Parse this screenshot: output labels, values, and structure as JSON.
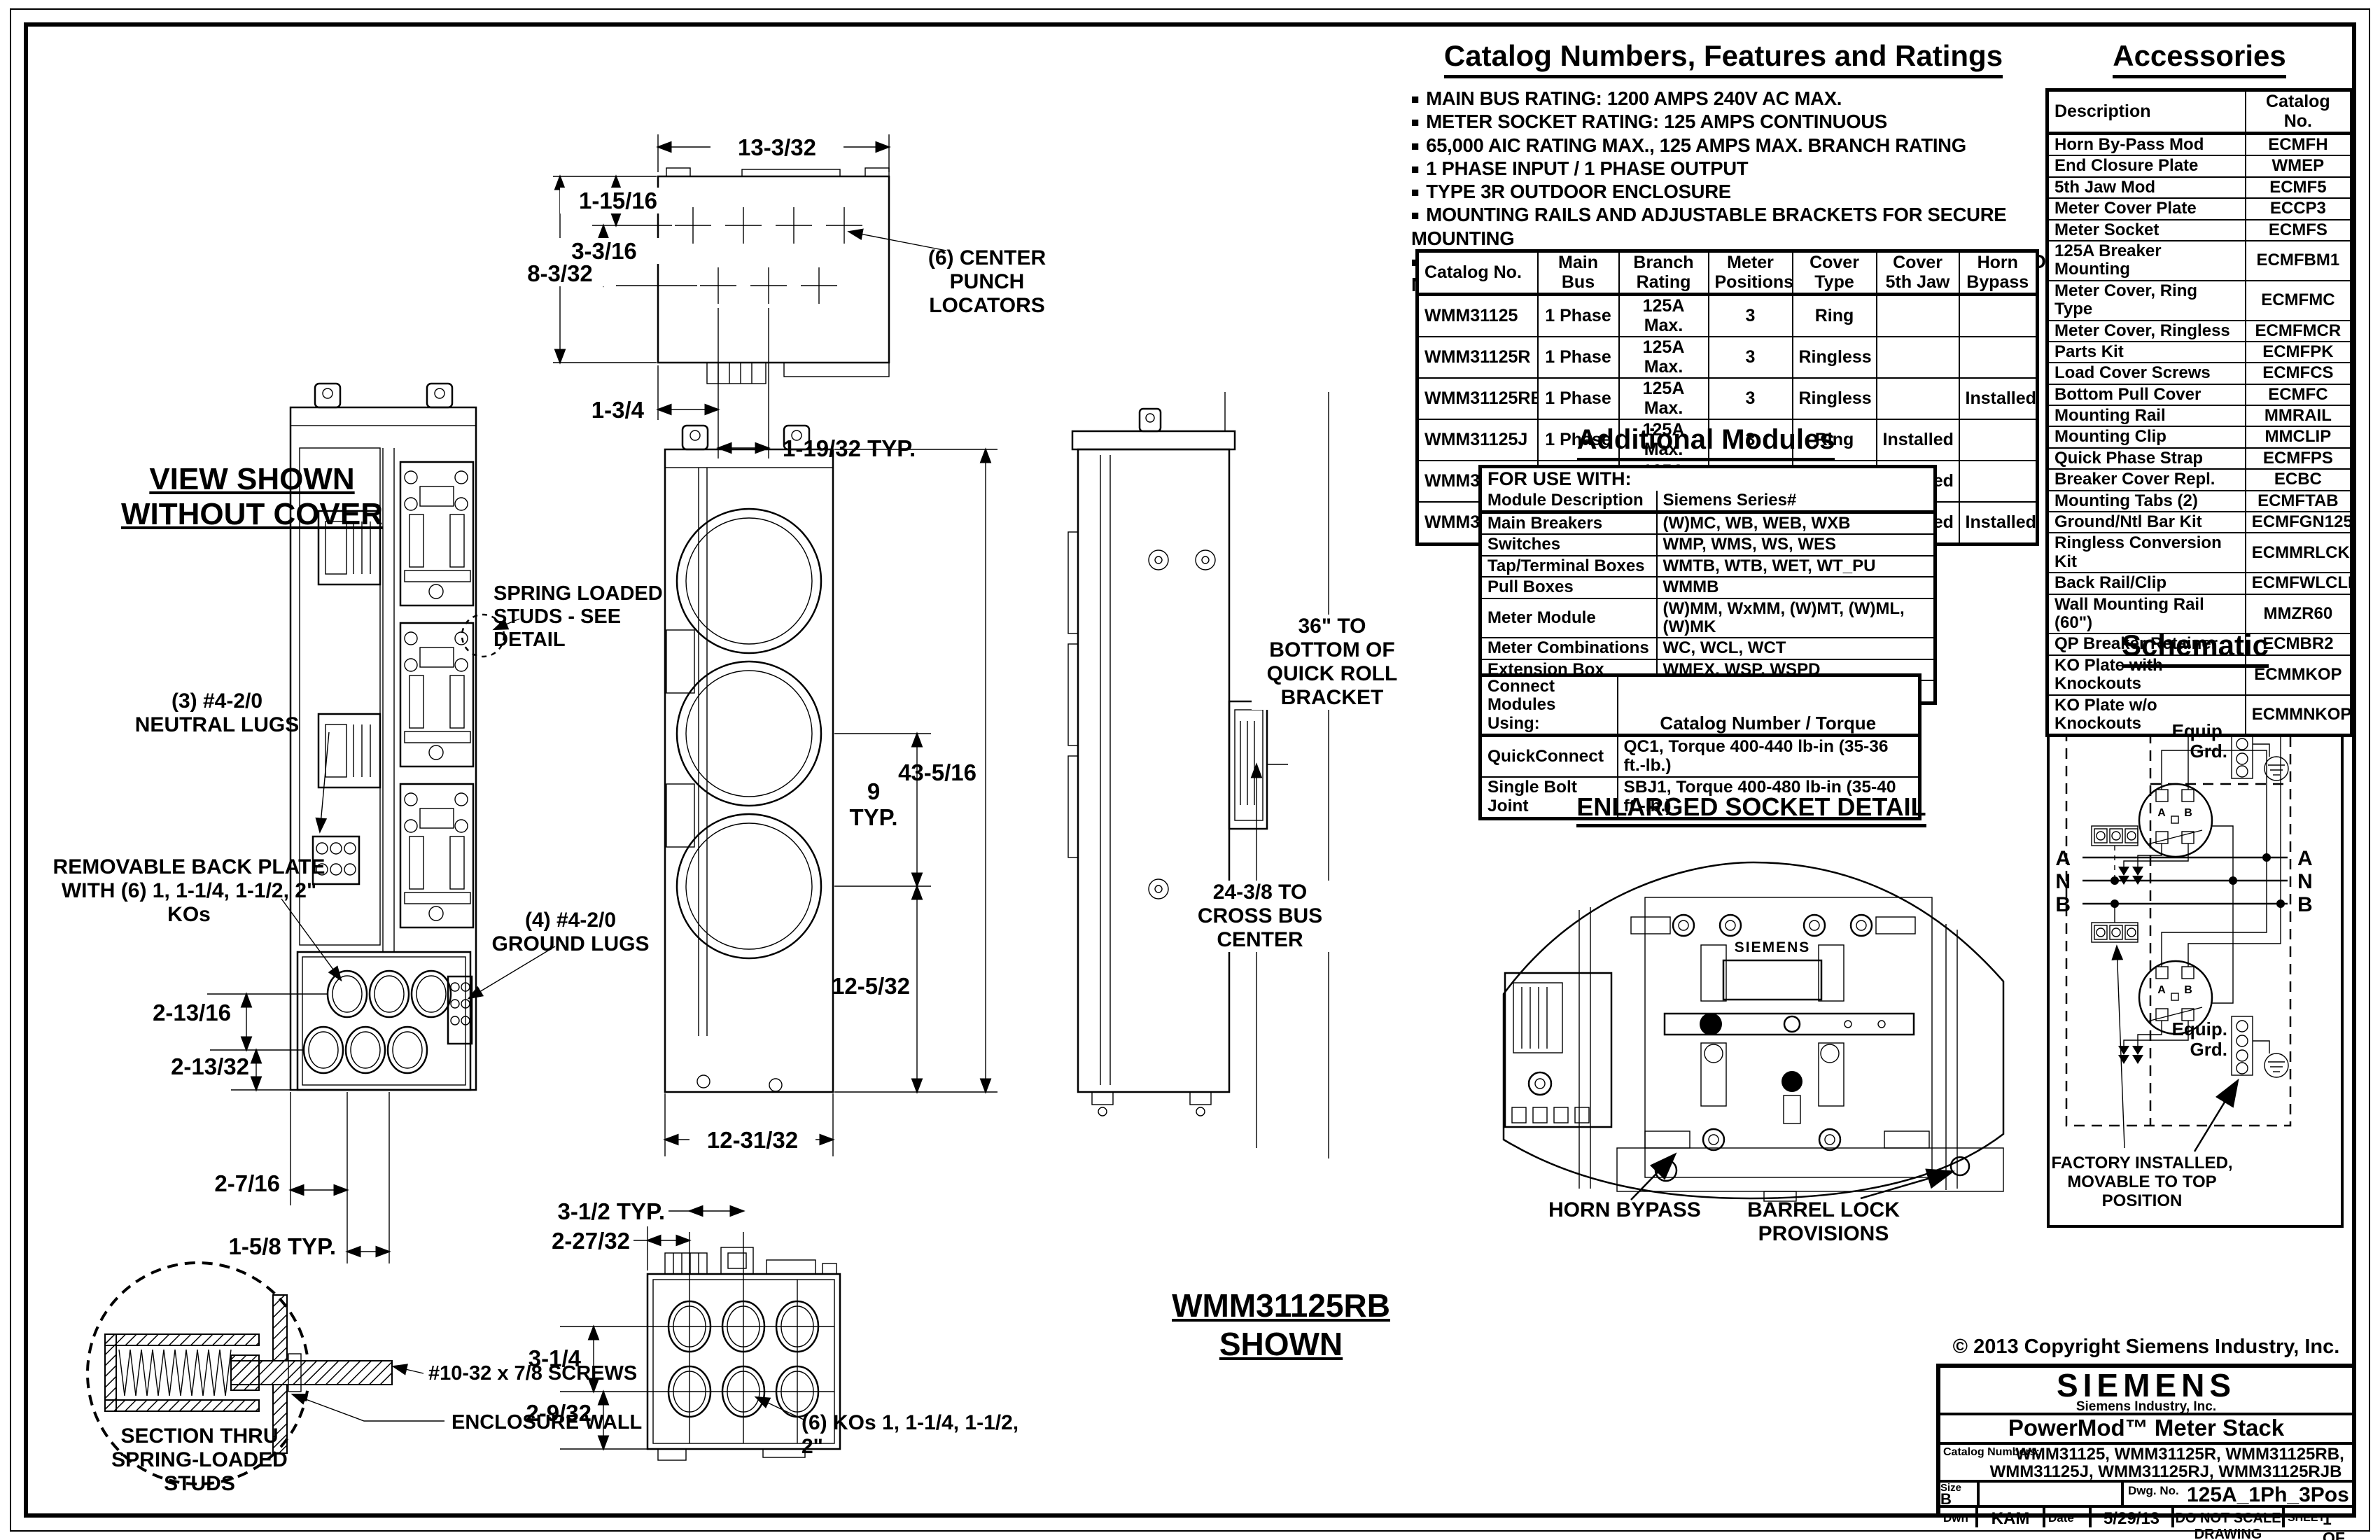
{
  "drawing": {
    "left_view": {
      "title": "VIEW SHOWN\nWITHOUT COVER",
      "labels": {
        "spring_studs": "SPRING LOADED\nSTUDS - SEE DETAIL",
        "neutral_lugs": "(3) #4-2/0\nNEUTRAL LUGS",
        "back_plate": "REMOVABLE BACK PLATE\nWITH (6) 1, 1-1/4, 1-1/2, 2\" KOs",
        "ground_lugs": "(4) #4-2/0\nGROUND LUGS"
      },
      "dims": {
        "d1": "2-13/16",
        "d2": "2-13/32",
        "d3": "2-7/16",
        "d4": "1-5/8  TYP."
      }
    },
    "top_view": {
      "dims": {
        "width": "13-3/32",
        "d1": "1-15/16",
        "d2": "3-3/16",
        "d3": "8-3/32",
        "d4": "1-3/4",
        "d5": "1-19/32  TYP."
      },
      "center_punch": "(6) CENTER PUNCH\nLOCATORS"
    },
    "center_view": {
      "dims": {
        "height": "43-5/16",
        "typ9": "9\nTYP.",
        "lower": "12-5/32",
        "width": "12-31/32"
      }
    },
    "side_view": {
      "quick_roll": "36\" TO\nBOTTOM OF\nQUICK ROLL\nBRACKET",
      "cross_bus": "24-3/8 TO\nCROSS BUS\nCENTER"
    },
    "bottom_view": {
      "dims": {
        "d1": "3-1/2  TYP.",
        "d2": "2-27/32",
        "d3": "3-1/4",
        "d4": "2-9/32"
      },
      "kos": "(6) KOs 1, 1-1/4, 1-1/2, 2\"",
      "shown": "WMM31125RB\nSHOWN"
    },
    "section_detail": {
      "title": "SECTION THRU\nSPRING-LOADED\nSTUDS",
      "screws": "#10-32 x 7/8 SCREWS",
      "wall": "ENCLOSURE WALL"
    }
  },
  "catalog_section": {
    "heading": "Catalog Numbers, Features and Ratings",
    "bullets": [
      "MAIN BUS RATING: 1200 AMPS 240V AC MAX.",
      "METER SOCKET RATING: 125 AMPS CONTINUOUS",
      "65,000 AIC RATING MAX., 125 AMPS MAX. BRANCH RATING",
      "1 PHASE INPUT / 1 PHASE OUTPUT",
      "TYPE 3R OUTDOOR ENCLOSURE",
      "MOUNTING RAILS AND ADJUSTABLE BRACKETS FOR SECURE MOUNTING",
      "CATALOG No. WITH RING TYPE COVER COMPLIES WITH EUSERC DWG No. 353"
    ],
    "table": {
      "headers": [
        "Catalog No.",
        "Main Bus",
        "Branch\nRating",
        "Meter\nPositions",
        "Cover\nType",
        "Cover\n5th Jaw",
        "Horn\nBypass"
      ],
      "rows": [
        [
          "WMM31125",
          "1 Phase",
          "125A Max.",
          "3",
          "Ring",
          "",
          ""
        ],
        [
          "WMM31125R",
          "1 Phase",
          "125A Max.",
          "3",
          "Ringless",
          "",
          ""
        ],
        [
          "WMM31125RB",
          "1 Phase",
          "125A Max.",
          "3",
          "Ringless",
          "",
          "Installed"
        ],
        [
          "WMM31125J",
          "1 Phase",
          "125A Max.",
          "3",
          "Ring",
          "Installed",
          ""
        ],
        [
          "WMM31125RJ",
          "1 Phase",
          "125A Max.",
          "3",
          "Ringless",
          "Installed",
          ""
        ],
        [
          "WMM31125RJB",
          "1 Phase",
          "125A Max.",
          "3",
          "Ringless",
          "Installed",
          "Installed"
        ]
      ]
    }
  },
  "additional_modules": {
    "heading": "Additional Modules",
    "for_use_with": "FOR USE WITH:",
    "col1": "Module Description",
    "col2": "Siemens Series#",
    "rows": [
      [
        "Main Breakers",
        "(W)MC, WB, WEB, WXB"
      ],
      [
        "Switches",
        "WMP, WMS, WS, WES"
      ],
      [
        "Tap/Terminal Boxes",
        "WMTB, WTB, WET, WT_PU"
      ],
      [
        "Pull Boxes",
        "WMMB"
      ],
      [
        "Meter Module",
        "(W)MM, WxMM, (W)MT, (W)ML, (W)MK"
      ],
      [
        "Meter Combinations",
        "WC, WCL, WCT"
      ],
      [
        "Extension Box",
        "WMEX, WSP, WSPD"
      ],
      [
        "Bussed Elbow",
        "BE"
      ]
    ]
  },
  "connect_modules": {
    "col1": "Connect Modules\nUsing:",
    "col2": "Catalog Number / Torque",
    "rows": [
      [
        "QuickConnect",
        "QC1, Torque 400-440 lb-in (35-36 ft.-lb.)"
      ],
      [
        "Single Bolt Joint",
        "SBJ1, Torque 400-480 lb-in (35-40 ft.-lb.)"
      ]
    ]
  },
  "socket_detail": {
    "heading": "ENLARGED SOCKET DETAIL",
    "brand": "SIEMENS",
    "horn_bypass": "HORN BYPASS",
    "barrel_lock": "BARREL LOCK\nPROVISIONS"
  },
  "accessories": {
    "heading": "Accessories",
    "headers": [
      "Description",
      "Catalog No."
    ],
    "rows": [
      [
        "Horn By-Pass Mod",
        "ECMFH"
      ],
      [
        "End Closure Plate",
        "WMEP"
      ],
      [
        "5th Jaw Mod",
        "ECMF5"
      ],
      [
        "Meter Cover Plate",
        "ECCP3"
      ],
      [
        "Meter Socket",
        "ECMFS"
      ],
      [
        "125A Breaker Mounting",
        "ECMFBM1"
      ],
      [
        "Meter Cover, Ring Type",
        "ECMFMC"
      ],
      [
        "Meter Cover, Ringless",
        "ECMFMCR"
      ],
      [
        "Parts Kit",
        "ECMFPK"
      ],
      [
        "Load Cover Screws",
        "ECMFCS"
      ],
      [
        "Bottom Pull Cover",
        "ECMFC"
      ],
      [
        "Mounting Rail",
        "MMRAIL"
      ],
      [
        "Mounting Clip",
        "MMCLIP"
      ],
      [
        "Quick Phase Strap",
        "ECMFPS"
      ],
      [
        "Breaker Cover Repl.",
        "ECBC"
      ],
      [
        "Mounting Tabs (2)",
        "ECMFTAB"
      ],
      [
        "Ground/Ntl Bar Kit",
        "ECMFGN125"
      ],
      [
        "Ringless Conversion Kit",
        "ECMMRLCK"
      ],
      [
        "Back Rail/Clip",
        "ECMFWLCLIP"
      ],
      [
        "Wall Mounting Rail (60\")",
        "MMZR60"
      ],
      [
        "QP Breaker Retainer",
        "ECMBR2"
      ],
      [
        "KO Plate with Knockouts",
        "ECMMKOP"
      ],
      [
        "KO Plate w/o Knockouts",
        "ECMMNKOP"
      ]
    ]
  },
  "schematic": {
    "heading": "Schematic",
    "equip_grd": "Equip.\nGrd.",
    "bus_left": [
      "A",
      "N",
      "B"
    ],
    "bus_right": [
      "A",
      "N",
      "B"
    ],
    "socket_a": "A",
    "socket_b": "B",
    "factory": "FACTORY INSTALLED,\nMOVABLE TO TOP POSITION"
  },
  "title_block": {
    "copyright": "© 2013 Copyright Siemens Industry, Inc.",
    "brand": "SIEMENS",
    "company": "Siemens Industry, Inc.",
    "product": "PowerMod™  Meter  Stack",
    "catalog_label": "Catalog Numbers:",
    "catalog_line1": "WMM31125, WMM31125R, WMM31125RB,",
    "catalog_line2": "WMM31125J, WMM31125RJ, WMM31125RJB",
    "size_label": "Size",
    "size_value": "B",
    "dwg_label": "Dwg. No.",
    "dwg_value": "125A_1Ph_3Pos",
    "dwn_label": "Dwn",
    "dwn_value": "KAM",
    "date_label": "Date",
    "date_value": "5/29/13",
    "no_scale": "DO NOT SCALE DRAWING",
    "sheet_label": "SHEET",
    "sheet_value": "1 OF 1"
  }
}
